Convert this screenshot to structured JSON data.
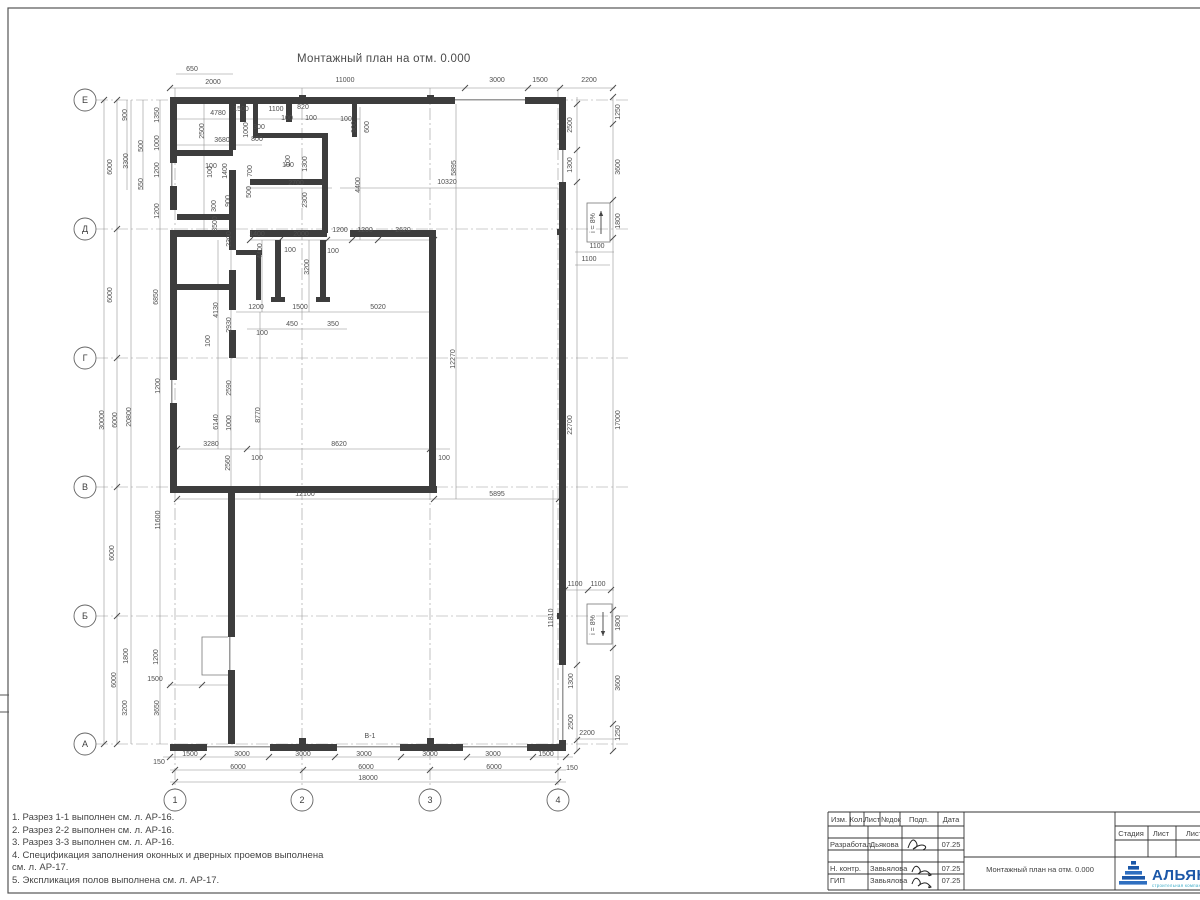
{
  "sheet": {
    "drawing_title": "Монтажный план на отм. 0.000",
    "bottom_wall_mark": "В-1"
  },
  "grid": {
    "rows": [
      {
        "label": "Е",
        "y": 100
      },
      {
        "label": "Д",
        "y": 229
      },
      {
        "label": "Г",
        "y": 358
      },
      {
        "label": "В",
        "y": 487
      },
      {
        "label": "Б",
        "y": 616
      },
      {
        "label": "А",
        "y": 744
      }
    ],
    "cols": [
      {
        "label": "1",
        "x": 175
      },
      {
        "label": "2",
        "x": 302
      },
      {
        "label": "3",
        "x": 430
      },
      {
        "label": "4",
        "x": 558
      }
    ]
  },
  "ramps": [
    {
      "label": "i = 8%",
      "x": 587,
      "y": 203,
      "w": 23,
      "h": 39,
      "dir": "up",
      "tx": 595,
      "ty": 223
    },
    {
      "label": "i = 8%",
      "x": 587,
      "y": 604,
      "w": 25,
      "h": 40,
      "dir": "down",
      "tx": 595,
      "ty": 625
    }
  ],
  "notes": [
    "1. Разрез 1-1 выполнен см. л. АР-16.",
    "2. Разрез 2-2 выполнен см. л. АР-16.",
    "3. Разрез 3-3 выполнен см. л. АР-16.",
    "4. Спецификация заполнения оконных и дверных проемов выполнена",
    "см. л. АР-17.",
    "5. Экспликация полов выполнена см. л. АР-17."
  ],
  "dims_h": [
    [
      192,
      71,
      "650"
    ],
    [
      213,
      84,
      "2000"
    ],
    [
      345,
      82,
      "11000"
    ],
    [
      497,
      82,
      "3000"
    ],
    [
      540,
      82,
      "1500"
    ],
    [
      589,
      82,
      "2200"
    ],
    [
      218,
      115,
      "4780"
    ],
    [
      241,
      111,
      "1500"
    ],
    [
      276,
      111,
      "1100"
    ],
    [
      303,
      109,
      "820"
    ],
    [
      259,
      129,
      "300"
    ],
    [
      257,
      141,
      "800"
    ],
    [
      222,
      142,
      "3680"
    ],
    [
      287,
      120,
      "100"
    ],
    [
      311,
      120,
      "100"
    ],
    [
      346,
      121,
      "100"
    ],
    [
      211,
      168,
      "100"
    ],
    [
      288,
      167,
      "100"
    ],
    [
      296,
      185,
      "2700"
    ],
    [
      447,
      184,
      "10320"
    ],
    [
      257,
      236,
      "1400"
    ],
    [
      301,
      236,
      "2000"
    ],
    [
      340,
      232,
      "1200"
    ],
    [
      365,
      232,
      "1200"
    ],
    [
      403,
      232,
      "2620"
    ],
    [
      290,
      252,
      "100"
    ],
    [
      333,
      253,
      "100"
    ],
    [
      256,
      309,
      "1200"
    ],
    [
      300,
      309,
      "1500"
    ],
    [
      378,
      309,
      "5020"
    ],
    [
      292,
      326,
      "450"
    ],
    [
      333,
      326,
      "350"
    ],
    [
      262,
      335,
      "100"
    ],
    [
      211,
      446,
      "3280"
    ],
    [
      339,
      446,
      "8620"
    ],
    [
      257,
      460,
      "100"
    ],
    [
      444,
      460,
      "100"
    ],
    [
      305,
      496,
      "12100"
    ],
    [
      497,
      496,
      "5895"
    ],
    [
      597,
      248,
      "1100"
    ],
    [
      589,
      261,
      "1100"
    ],
    [
      575,
      586,
      "1100"
    ],
    [
      598,
      586,
      "1100"
    ],
    [
      587,
      735,
      "2200"
    ],
    [
      190,
      756,
      "1500"
    ],
    [
      242,
      756,
      "3000"
    ],
    [
      303,
      756,
      "3000"
    ],
    [
      364,
      756,
      "3000"
    ],
    [
      430,
      756,
      "3000"
    ],
    [
      493,
      756,
      "3000"
    ],
    [
      546,
      756,
      "1500"
    ],
    [
      238,
      769,
      "6000"
    ],
    [
      366,
      769,
      "6000"
    ],
    [
      494,
      769,
      "6000"
    ],
    [
      368,
      780,
      "18000"
    ],
    [
      159,
      764,
      "150"
    ],
    [
      572,
      770,
      "150"
    ],
    [
      155,
      681,
      "1500"
    ]
  ],
  "dims_v": [
    [
      127,
      115,
      "900"
    ],
    [
      159,
      115,
      "1350"
    ],
    [
      143,
      146,
      "500"
    ],
    [
      159,
      143,
      "1000"
    ],
    [
      128,
      161,
      "3300"
    ],
    [
      112,
      167,
      "6000"
    ],
    [
      159,
      170,
      "1200"
    ],
    [
      143,
      184,
      "550"
    ],
    [
      159,
      211,
      "1200"
    ],
    [
      112,
      295,
      "6000"
    ],
    [
      158,
      297,
      "6850"
    ],
    [
      104,
      420,
      "30000"
    ],
    [
      117,
      420,
      "6000"
    ],
    [
      131,
      417,
      "20800"
    ],
    [
      160,
      386,
      "1200"
    ],
    [
      160,
      520,
      "11600"
    ],
    [
      114,
      553,
      "6000"
    ],
    [
      128,
      656,
      "1800"
    ],
    [
      158,
      657,
      "1200"
    ],
    [
      116,
      680,
      "6000"
    ],
    [
      127,
      708,
      "3200"
    ],
    [
      159,
      708,
      "3650"
    ],
    [
      204,
      131,
      "2500"
    ],
    [
      248,
      130,
      "1000"
    ],
    [
      356,
      127,
      "900"
    ],
    [
      369,
      127,
      "600"
    ],
    [
      290,
      161,
      "100"
    ],
    [
      307,
      164,
      "1300"
    ],
    [
      307,
      200,
      "2300"
    ],
    [
      360,
      185,
      "4400"
    ],
    [
      227,
      171,
      "1400"
    ],
    [
      252,
      171,
      "700"
    ],
    [
      212,
      172,
      "100"
    ],
    [
      216,
      206,
      "300"
    ],
    [
      230,
      201,
      "900"
    ],
    [
      251,
      192,
      "500"
    ],
    [
      217,
      224,
      "3500"
    ],
    [
      231,
      239,
      "2300"
    ],
    [
      262,
      251,
      "4400"
    ],
    [
      309,
      267,
      "3200"
    ],
    [
      218,
      310,
      "4130"
    ],
    [
      231,
      325,
      "2930"
    ],
    [
      210,
      341,
      "100"
    ],
    [
      231,
      388,
      "2590"
    ],
    [
      260,
      415,
      "8770"
    ],
    [
      218,
      422,
      "6140"
    ],
    [
      231,
      423,
      "1000"
    ],
    [
      230,
      463,
      "2560"
    ],
    [
      456,
      168,
      "5895"
    ],
    [
      455,
      359,
      "12270"
    ],
    [
      572,
      425,
      "22700"
    ],
    [
      620,
      420,
      "17000"
    ],
    [
      572,
      125,
      "2500"
    ],
    [
      620,
      112,
      "1250"
    ],
    [
      572,
      165,
      "1300"
    ],
    [
      620,
      167,
      "3600"
    ],
    [
      620,
      221,
      "1800"
    ],
    [
      553,
      618,
      "11810"
    ],
    [
      573,
      681,
      "1300"
    ],
    [
      620,
      623,
      "1800"
    ],
    [
      620,
      683,
      "3600"
    ],
    [
      573,
      722,
      "2500"
    ],
    [
      620,
      733,
      "1250"
    ]
  ],
  "titleblock": {
    "header_cols": [
      {
        "t": "Изм.",
        "x": 839
      },
      {
        "t": "Кол.",
        "x": 857
      },
      {
        "t": "Лист",
        "x": 872
      },
      {
        "t": "№док",
        "x": 891
      },
      {
        "t": "Подп.",
        "x": 919
      },
      {
        "t": "Дата",
        "x": 951
      }
    ],
    "rows": [
      {
        "role": "Разработал",
        "name": "Дьякова",
        "date": "07.25",
        "y": 847
      },
      {
        "role": "Н. контр.",
        "name": "Завьялова",
        "date": "07.25",
        "y": 871
      },
      {
        "role": "ГИП",
        "name": "Завьялова",
        "date": "07.25",
        "y": 883
      }
    ],
    "doc_title": "Монтажный план на отм. 0.000",
    "stage_cols": [
      {
        "t": "Стадия",
        "x": 1131
      },
      {
        "t": "Лист",
        "x": 1161
      },
      {
        "t": "Лист",
        "x": 1194
      }
    ],
    "logo": {
      "name": "АЛЬЯНС",
      "sub": "строительная компания"
    }
  },
  "colors": {
    "wall": "#3d3d3d",
    "sill": "#9a9a9a",
    "chain": "#8a8a8a",
    "dim_text": "#4f4f4f",
    "grid": "#9a9a9a",
    "logo_blue": "#1b57a8",
    "logo_teal": "#2fa6c4"
  },
  "geometry": {
    "walls": [
      [
        170,
        97,
        285,
        7
      ],
      [
        525,
        97,
        41,
        7
      ],
      [
        559,
        97,
        7,
        53
      ],
      [
        559,
        182,
        7,
        483
      ],
      [
        559,
        740,
        7,
        11
      ],
      [
        170,
        744,
        37,
        7
      ],
      [
        270,
        744,
        67,
        7
      ],
      [
        400,
        744,
        63,
        7
      ],
      [
        527,
        744,
        39,
        7
      ],
      [
        170,
        97,
        7,
        66
      ],
      [
        170,
        186,
        7,
        24
      ],
      [
        170,
        233,
        7,
        147
      ],
      [
        170,
        403,
        7,
        90
      ],
      [
        228,
        487,
        7,
        150
      ],
      [
        228,
        670,
        7,
        74
      ],
      [
        170,
        486,
        267,
        7
      ],
      [
        429,
        233,
        7,
        260
      ],
      [
        170,
        230,
        63,
        7
      ],
      [
        250,
        230,
        77,
        7
      ],
      [
        350,
        230,
        86,
        7
      ],
      [
        229,
        104,
        7,
        46
      ],
      [
        229,
        170,
        7,
        80
      ],
      [
        229,
        270,
        7,
        40
      ],
      [
        229,
        330,
        7,
        28
      ],
      [
        177,
        150,
        56,
        6
      ],
      [
        177,
        214,
        56,
        6
      ],
      [
        177,
        284,
        56,
        6
      ],
      [
        240,
        104,
        6,
        18
      ],
      [
        286,
        104,
        6,
        18
      ],
      [
        253,
        104,
        5,
        29
      ],
      [
        322,
        133,
        6,
        100
      ],
      [
        253,
        133,
        74,
        5
      ],
      [
        250,
        179,
        78,
        6
      ],
      [
        352,
        104,
        5,
        33
      ],
      [
        275,
        240,
        6,
        60
      ],
      [
        320,
        240,
        6,
        60
      ],
      [
        271,
        297,
        14,
        5
      ],
      [
        316,
        297,
        14,
        5
      ],
      [
        256,
        255,
        5,
        45
      ],
      [
        236,
        250,
        26,
        5
      ],
      [
        299,
        738,
        7,
        6
      ],
      [
        427,
        738,
        7,
        6
      ],
      [
        299,
        95,
        7,
        6
      ],
      [
        427,
        95,
        7,
        6
      ],
      [
        557,
        229,
        6,
        6
      ],
      [
        557,
        613,
        6,
        6
      ]
    ],
    "sills": [
      [
        455,
        99,
        70,
        1.5
      ],
      [
        207,
        746,
        63,
        1.5
      ],
      [
        337,
        746,
        63,
        1.5
      ],
      [
        463,
        746,
        64,
        1.5
      ],
      [
        171,
        163,
        1.5,
        23
      ],
      [
        171,
        380,
        1.5,
        23
      ],
      [
        562,
        150,
        1.5,
        32
      ],
      [
        562,
        665,
        1.5,
        75
      ],
      [
        229,
        637,
        1.5,
        33
      ]
    ],
    "chains": [
      [
        170,
        88,
        615,
        88
      ],
      [
        176,
        74,
        233,
        74
      ],
      [
        163,
        757,
        573,
        757
      ],
      [
        170,
        770,
        566,
        770
      ],
      [
        170,
        782,
        566,
        782
      ],
      [
        177,
        119,
        360,
        119
      ],
      [
        177,
        145,
        262,
        145
      ],
      [
        247,
        188,
        332,
        188
      ],
      [
        340,
        188,
        558,
        188
      ],
      [
        250,
        240,
        436,
        240
      ],
      [
        236,
        312,
        436,
        312
      ],
      [
        247,
        329,
        347,
        329
      ],
      [
        177,
        449,
        450,
        449
      ],
      [
        177,
        499,
        566,
        499
      ],
      [
        575,
        252,
        614,
        252
      ],
      [
        575,
        265,
        610,
        265
      ],
      [
        565,
        590,
        614,
        590
      ],
      [
        575,
        739,
        616,
        739
      ],
      [
        168,
        685,
        232,
        685
      ],
      [
        104,
        100,
        104,
        744
      ],
      [
        117,
        100,
        117,
        744
      ],
      [
        131,
        100,
        131,
        744
      ],
      [
        160,
        100,
        160,
        744
      ],
      [
        127,
        100,
        127,
        190
      ],
      [
        143,
        100,
        143,
        190
      ],
      [
        204,
        104,
        204,
        237
      ],
      [
        360,
        107,
        360,
        240
      ],
      [
        262,
        240,
        262,
        312
      ],
      [
        309,
        240,
        309,
        312
      ],
      [
        218,
        240,
        218,
        449
      ],
      [
        231,
        240,
        231,
        499
      ],
      [
        260,
        312,
        260,
        499
      ],
      [
        456,
        104,
        456,
        499
      ],
      [
        577,
        97,
        577,
        751
      ],
      [
        613,
        97,
        613,
        751
      ],
      [
        553,
        490,
        553,
        744
      ]
    ],
    "ticks": [
      [
        170,
        88
      ],
      [
        465,
        88
      ],
      [
        528,
        88
      ],
      [
        560,
        88
      ],
      [
        613,
        88
      ],
      [
        170,
        757
      ],
      [
        203,
        757
      ],
      [
        269,
        757
      ],
      [
        335,
        757
      ],
      [
        401,
        757
      ],
      [
        467,
        757
      ],
      [
        533,
        757
      ],
      [
        566,
        757
      ],
      [
        175,
        770
      ],
      [
        303,
        770
      ],
      [
        430,
        770
      ],
      [
        558,
        770
      ],
      [
        175,
        782
      ],
      [
        558,
        782
      ],
      [
        117,
        100
      ],
      [
        117,
        229
      ],
      [
        117,
        358
      ],
      [
        117,
        487
      ],
      [
        117,
        616
      ],
      [
        117,
        744
      ],
      [
        104,
        100
      ],
      [
        104,
        744
      ],
      [
        613,
        97
      ],
      [
        613,
        124
      ],
      [
        613,
        200
      ],
      [
        613,
        238
      ],
      [
        613,
        610
      ],
      [
        613,
        648
      ],
      [
        613,
        724
      ],
      [
        613,
        751
      ],
      [
        577,
        104
      ],
      [
        577,
        150
      ],
      [
        577,
        182
      ],
      [
        577,
        665
      ],
      [
        577,
        740
      ],
      [
        577,
        751
      ],
      [
        177,
        499
      ],
      [
        434,
        499
      ],
      [
        559,
        499
      ],
      [
        177,
        449
      ],
      [
        247,
        449
      ],
      [
        430,
        449
      ],
      [
        250,
        240
      ],
      [
        280,
        240
      ],
      [
        327,
        240
      ],
      [
        352,
        240
      ],
      [
        378,
        240
      ],
      [
        434,
        240
      ],
      [
        565,
        590
      ],
      [
        588,
        590
      ],
      [
        611,
        590
      ],
      [
        170,
        685
      ],
      [
        202,
        685
      ]
    ],
    "tb_h": [
      [
        828,
        812,
        1200,
        812
      ],
      [
        828,
        826,
        964,
        826
      ],
      [
        828,
        838,
        964,
        838
      ],
      [
        828,
        850,
        964,
        850
      ],
      [
        828,
        862,
        964,
        862
      ],
      [
        828,
        874,
        964,
        874
      ],
      [
        828,
        890,
        1200,
        890
      ],
      [
        964,
        857,
        1200,
        857
      ],
      [
        1115,
        826,
        1200,
        826
      ],
      [
        1115,
        840,
        1200,
        840
      ]
    ],
    "tb_v": [
      [
        828,
        812,
        828,
        890
      ],
      [
        850,
        812,
        850,
        826
      ],
      [
        864,
        812,
        864,
        826
      ],
      [
        880,
        812,
        880,
        826
      ],
      [
        900,
        812,
        900,
        826
      ],
      [
        868,
        826,
        868,
        890
      ],
      [
        902,
        826,
        902,
        890
      ],
      [
        938,
        812,
        938,
        890
      ],
      [
        964,
        812,
        964,
        890
      ],
      [
        1115,
        812,
        1115,
        890
      ],
      [
        1148,
        826,
        1148,
        857
      ],
      [
        1176,
        826,
        1176,
        857
      ]
    ]
  }
}
